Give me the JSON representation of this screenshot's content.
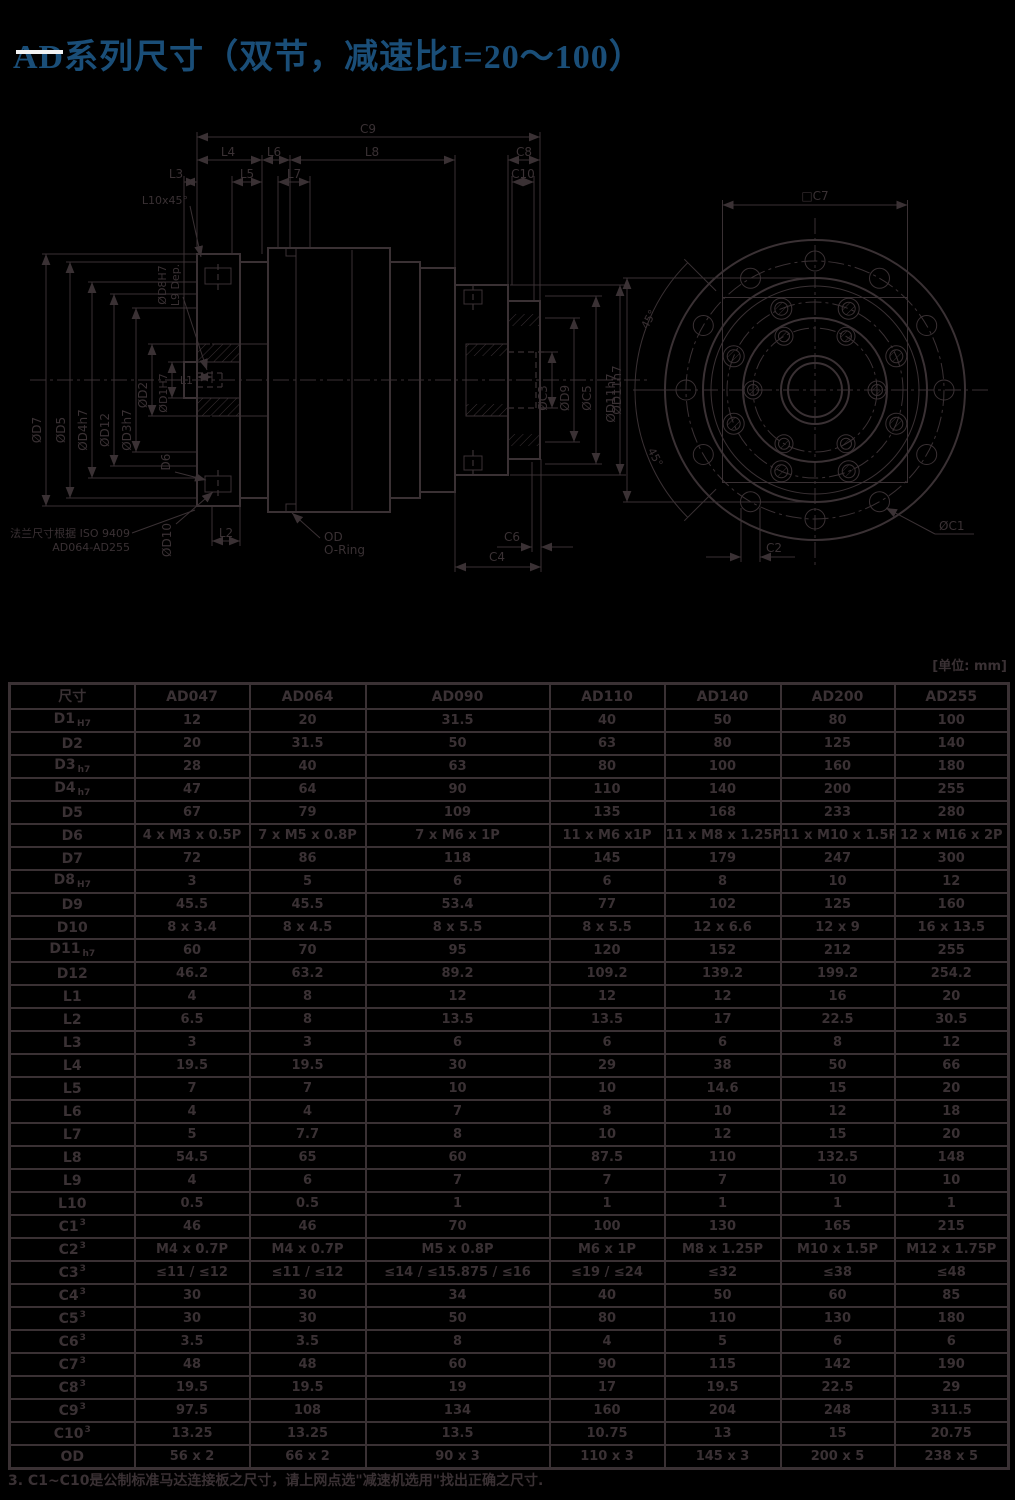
{
  "page": {
    "title": "AD系列尺寸（双节，减速比I=20～100）",
    "unit_label": "[单位: mm]",
    "footnote": "3. C1~C10是公制标准马达连接板之尺寸，请上网点选\"减速机选用\"找出正确之尺寸."
  },
  "drawing": {
    "dims": {
      "c9": "C9",
      "l4": "L4",
      "l6": "L6",
      "l8": "L8",
      "c8": "C8",
      "l3": "L3",
      "l5": "L5",
      "l7": "L7",
      "c10": "C10",
      "l10": "L10x45°",
      "d7": "ØD7",
      "d5": "ØD5",
      "d4": "ØD4h7",
      "d12": "ØD12",
      "d3": "ØD3h7",
      "d2": "ØD2",
      "d1": "ØD1H7",
      "d8": "ØD8H7",
      "l9": "L9 Dep.",
      "l1": "L1",
      "d6": "D6",
      "d10": "ØD10",
      "l2": "L2",
      "c3": "ØC3",
      "d9": "ØD9",
      "c5": "ØC5",
      "d11": "ØD11h7",
      "c6": "C6",
      "c4": "C4",
      "od_line1": "OD",
      "od_line2": "O-Ring",
      "note_line1": "法兰尺寸根据 ISO 9409",
      "note_line2": "AD064-AD255",
      "c7": "□C7",
      "d11_front": "ØD11h7",
      "deg1": "45°",
      "deg2": "45°",
      "c2": "C2",
      "c1": "ØC1"
    }
  },
  "table": {
    "headers": [
      "尺寸",
      "AD047",
      "AD064",
      "AD090",
      "AD110",
      "AD140",
      "AD200",
      "AD255"
    ],
    "rows": [
      {
        "base": "D1",
        "sub": "H7",
        "values": [
          "12",
          "20",
          "31.5",
          "40",
          "50",
          "80",
          "100"
        ]
      },
      {
        "base": "D2",
        "values": [
          "20",
          "31.5",
          "50",
          "63",
          "80",
          "125",
          "140"
        ]
      },
      {
        "base": "D3",
        "sub": "h7",
        "values": [
          "28",
          "40",
          "63",
          "80",
          "100",
          "160",
          "180"
        ]
      },
      {
        "base": "D4",
        "sub": "h7",
        "values": [
          "47",
          "64",
          "90",
          "110",
          "140",
          "200",
          "255"
        ]
      },
      {
        "base": "D5",
        "values": [
          "67",
          "79",
          "109",
          "135",
          "168",
          "233",
          "280"
        ]
      },
      {
        "base": "D6",
        "values": [
          "4 x M3 x 0.5P",
          "7 x M5 x 0.8P",
          "7 x M6 x 1P",
          "11 x M6 x1P",
          "11 x M8 x 1.25P",
          "11 x M10 x 1.5P",
          "12 x M16 x 2P"
        ]
      },
      {
        "base": "D7",
        "values": [
          "72",
          "86",
          "118",
          "145",
          "179",
          "247",
          "300"
        ]
      },
      {
        "base": "D8",
        "sub": "H7",
        "values": [
          "3",
          "5",
          "6",
          "6",
          "8",
          "10",
          "12"
        ]
      },
      {
        "base": "D9",
        "values": [
          "45.5",
          "45.5",
          "53.4",
          "77",
          "102",
          "125",
          "160"
        ]
      },
      {
        "base": "D10",
        "values": [
          "8 x 3.4",
          "8 x 4.5",
          "8 x 5.5",
          "8 x 5.5",
          "12 x 6.6",
          "12 x 9",
          "16 x 13.5"
        ]
      },
      {
        "base": "D11",
        "sub": "h7",
        "values": [
          "60",
          "70",
          "95",
          "120",
          "152",
          "212",
          "255"
        ]
      },
      {
        "base": "D12",
        "values": [
          "46.2",
          "63.2",
          "89.2",
          "109.2",
          "139.2",
          "199.2",
          "254.2"
        ]
      },
      {
        "base": "L1",
        "values": [
          "4",
          "8",
          "12",
          "12",
          "12",
          "16",
          "20"
        ]
      },
      {
        "base": "L2",
        "values": [
          "6.5",
          "8",
          "13.5",
          "13.5",
          "17",
          "22.5",
          "30.5"
        ]
      },
      {
        "base": "L3",
        "values": [
          "3",
          "3",
          "6",
          "6",
          "6",
          "8",
          "12"
        ]
      },
      {
        "base": "L4",
        "values": [
          "19.5",
          "19.5",
          "30",
          "29",
          "38",
          "50",
          "66"
        ]
      },
      {
        "base": "L5",
        "values": [
          "7",
          "7",
          "10",
          "10",
          "14.6",
          "15",
          "20"
        ]
      },
      {
        "base": "L6",
        "values": [
          "4",
          "4",
          "7",
          "8",
          "10",
          "12",
          "18"
        ]
      },
      {
        "base": "L7",
        "values": [
          "5",
          "7.7",
          "8",
          "10",
          "12",
          "15",
          "20"
        ]
      },
      {
        "base": "L8",
        "values": [
          "54.5",
          "65",
          "60",
          "87.5",
          "110",
          "132.5",
          "148"
        ]
      },
      {
        "base": "L9",
        "values": [
          "4",
          "6",
          "7",
          "7",
          "7",
          "10",
          "10"
        ]
      },
      {
        "base": "L10",
        "values": [
          "0.5",
          "0.5",
          "1",
          "1",
          "1",
          "1",
          "1"
        ]
      },
      {
        "base": "C1",
        "sup": "3",
        "values": [
          "46",
          "46",
          "70",
          "100",
          "130",
          "165",
          "215"
        ]
      },
      {
        "base": "C2",
        "sup": "3",
        "values": [
          "M4 x 0.7P",
          "M4 x 0.7P",
          "M5 x 0.8P",
          "M6 x 1P",
          "M8 x 1.25P",
          "M10 x 1.5P",
          "M12 x 1.75P"
        ]
      },
      {
        "base": "C3",
        "sup": "3",
        "values": [
          "≤11 / ≤12",
          "≤11 / ≤12",
          "≤14 / ≤15.875 / ≤16",
          "≤19 / ≤24",
          "≤32",
          "≤38",
          "≤48"
        ]
      },
      {
        "base": "C4",
        "sup": "3",
        "values": [
          "30",
          "30",
          "34",
          "40",
          "50",
          "60",
          "85"
        ]
      },
      {
        "base": "C5",
        "sup": "3",
        "values": [
          "30",
          "30",
          "50",
          "80",
          "110",
          "130",
          "180"
        ]
      },
      {
        "base": "C6",
        "sup": "3",
        "values": [
          "3.5",
          "3.5",
          "8",
          "4",
          "5",
          "6",
          "6"
        ]
      },
      {
        "base": "C7",
        "sup": "3",
        "values": [
          "48",
          "48",
          "60",
          "90",
          "115",
          "142",
          "190"
        ]
      },
      {
        "base": "C8",
        "sup": "3",
        "values": [
          "19.5",
          "19.5",
          "19",
          "17",
          "19.5",
          "22.5",
          "29"
        ]
      },
      {
        "base": "C9",
        "sup": "3",
        "values": [
          "97.5",
          "108",
          "134",
          "160",
          "204",
          "248",
          "311.5"
        ]
      },
      {
        "base": "C10",
        "sup": "3",
        "values": [
          "13.25",
          "13.25",
          "13.5",
          "10.75",
          "13",
          "15",
          "20.75"
        ]
      },
      {
        "base": "OD",
        "values": [
          "56 x 2",
          "66 x 2",
          "90 x 3",
          "110 x 3",
          "145 x 3",
          "200 x 5",
          "238 x 5"
        ]
      }
    ]
  }
}
